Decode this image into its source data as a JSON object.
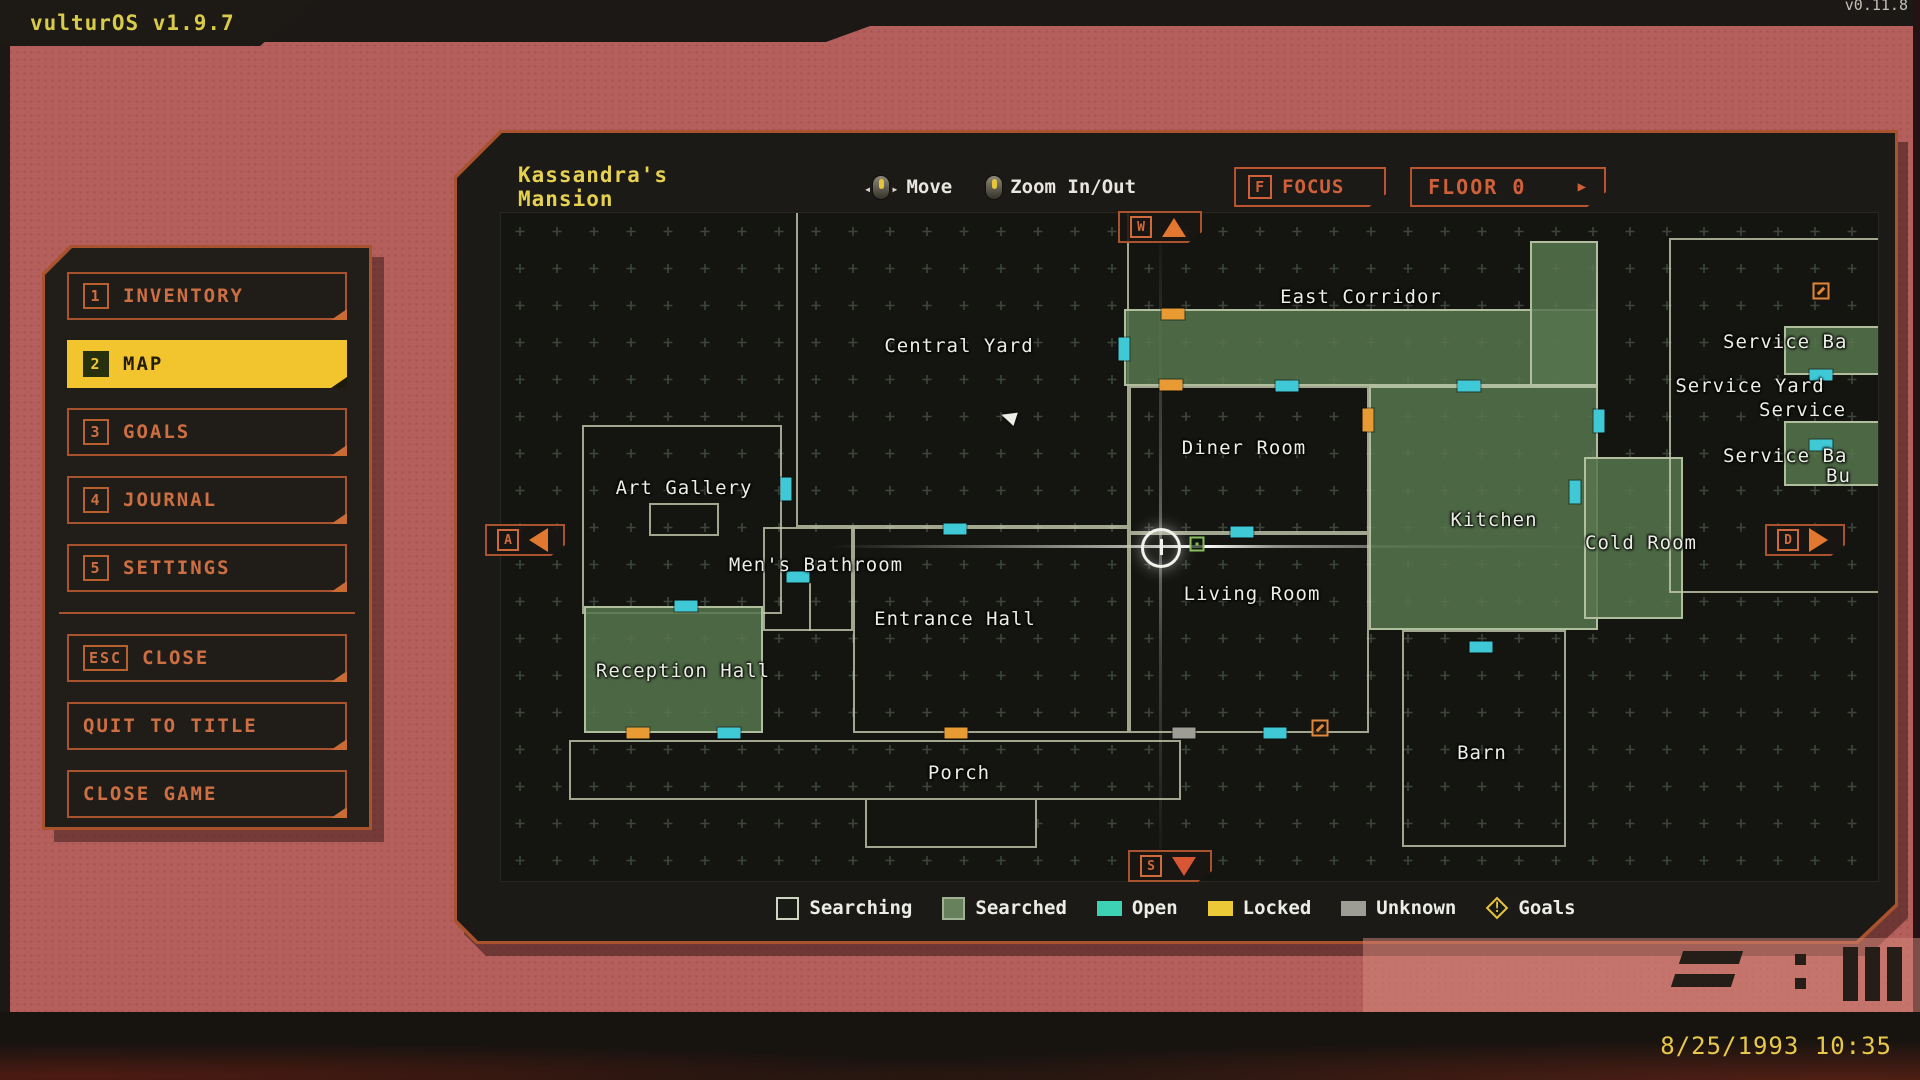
{
  "os": {
    "title": "vulturOS v1.9.7",
    "corner_version": "v0.11.8",
    "datetime": "8/25/1993 10:35"
  },
  "sidebar": {
    "items": [
      {
        "key": "1",
        "label": "INVENTORY"
      },
      {
        "key": "2",
        "label": "MAP"
      },
      {
        "key": "3",
        "label": "GOALS"
      },
      {
        "key": "4",
        "label": "JOURNAL"
      },
      {
        "key": "5",
        "label": "SETTINGS"
      },
      {
        "key": "ESC",
        "label": "CLOSE"
      },
      {
        "key": "",
        "label": "QUIT TO TITLE"
      },
      {
        "key": "",
        "label": "CLOSE GAME"
      }
    ]
  },
  "map": {
    "title": "Kassandra's Mansion",
    "controls": {
      "move_label": "Move",
      "zoom_label": "Zoom In/Out",
      "focus_key": "F",
      "focus_label": "FOCUS",
      "floor_label": "FLOOR 0",
      "floor_arrow": "▶"
    },
    "nav_keys": {
      "up": "W",
      "left": "A",
      "right": "D",
      "down": "S"
    },
    "legend": [
      {
        "label": "Searching"
      },
      {
        "label": "Searched"
      },
      {
        "label": "Open"
      },
      {
        "label": "Locked"
      },
      {
        "label": "Unknown"
      },
      {
        "label": "Goals"
      }
    ],
    "rooms": [
      {
        "id": "central-yard",
        "x": 295,
        "y": -6,
        "w": 333,
        "h": 320,
        "s": "searching"
      },
      {
        "id": "art-gallery",
        "x": 81,
        "y": 212,
        "w": 200,
        "h": 189,
        "s": "searching"
      },
      {
        "id": "gallery-closet",
        "x": 148,
        "y": 290,
        "w": 70,
        "h": 33,
        "s": "searching"
      },
      {
        "id": "mens-bathroom",
        "x": 262,
        "y": 314,
        "w": 90,
        "h": 104,
        "s": "searching"
      },
      {
        "id": "bathroom-divider",
        "x": 308,
        "y": 370,
        "w": 2,
        "h": 48,
        "s": "wall"
      },
      {
        "id": "entrance-hall",
        "x": 352,
        "y": 314,
        "w": 276,
        "h": 206,
        "s": "searching"
      },
      {
        "id": "reception-hall",
        "x": 83,
        "y": 393,
        "w": 179,
        "h": 127,
        "s": "searched"
      },
      {
        "id": "porch",
        "x": 68,
        "y": 527,
        "w": 612,
        "h": 60,
        "s": "searching"
      },
      {
        "id": "porch-steps",
        "x": 364,
        "y": 585,
        "w": 172,
        "h": 50,
        "s": "searching",
        "f": 1
      },
      {
        "id": "diner-room",
        "x": 628,
        "y": 173,
        "w": 240,
        "h": 147,
        "s": "searching"
      },
      {
        "id": "living-room",
        "x": 628,
        "y": 320,
        "w": 240,
        "h": 200,
        "s": "searching"
      },
      {
        "id": "east-corridor",
        "x": 623,
        "y": 96,
        "w": 474,
        "h": 77,
        "s": "searched"
      },
      {
        "id": "east-corridor-upper",
        "x": 1029,
        "y": 28,
        "w": 68,
        "h": 145,
        "s": "searched"
      },
      {
        "id": "kitchen",
        "x": 868,
        "y": 173,
        "w": 229,
        "h": 244,
        "s": "searched"
      },
      {
        "id": "cold-room",
        "x": 1083,
        "y": 244,
        "w": 99,
        "h": 162,
        "s": "searched"
      },
      {
        "id": "barn",
        "x": 901,
        "y": 417,
        "w": 164,
        "h": 217,
        "s": "searching"
      },
      {
        "id": "service-yard",
        "x": 1168,
        "y": 25,
        "w": 215,
        "h": 355,
        "s": "searching"
      },
      {
        "id": "service-room-a",
        "x": 1283,
        "y": 113,
        "w": 100,
        "h": 49,
        "s": "searched"
      },
      {
        "id": "service-room-b",
        "x": 1283,
        "y": 208,
        "w": 100,
        "h": 65,
        "s": "searched"
      }
    ],
    "labels": [
      {
        "t": "Central Yard",
        "x": 458,
        "y": 133
      },
      {
        "t": "East Corridor",
        "x": 860,
        "y": 84
      },
      {
        "t": "Art Gallery",
        "x": 183,
        "y": 275
      },
      {
        "t": "Diner Room",
        "x": 743,
        "y": 235
      },
      {
        "t": "Men's Bathroom",
        "x": 315,
        "y": 352
      },
      {
        "t": "Entrance Hall",
        "x": 454,
        "y": 406
      },
      {
        "t": "Living Room",
        "x": 751,
        "y": 381
      },
      {
        "t": "Reception Hall",
        "x": 182,
        "y": 458
      },
      {
        "t": "Kitchen",
        "x": 993,
        "y": 307
      },
      {
        "t": "Cold Room",
        "x": 1140,
        "y": 330
      },
      {
        "t": "Porch",
        "x": 458,
        "y": 560
      },
      {
        "t": "Barn",
        "x": 981,
        "y": 540
      },
      {
        "t": "Service Yard",
        "x": 1249,
        "y": 173
      },
      {
        "t": "Service Ba",
        "x": 1222,
        "y": 118,
        "a": "l"
      },
      {
        "t": "Service",
        "x": 1258,
        "y": 186,
        "a": "l"
      },
      {
        "t": "Service Ba",
        "x": 1222,
        "y": 232,
        "a": "l"
      },
      {
        "t": "Bu",
        "x": 1325,
        "y": 252,
        "a": "l"
      }
    ],
    "doors": [
      {
        "x": 454,
        "y": 316,
        "o": "h",
        "t": "o"
      },
      {
        "x": 285,
        "y": 276,
        "o": "v",
        "t": "o"
      },
      {
        "x": 297,
        "y": 364,
        "o": "h",
        "t": "o"
      },
      {
        "x": 185,
        "y": 393,
        "o": "h",
        "t": "o"
      },
      {
        "x": 137,
        "y": 520,
        "o": "h",
        "t": "l"
      },
      {
        "x": 228,
        "y": 520,
        "o": "h",
        "t": "o"
      },
      {
        "x": 455,
        "y": 520,
        "o": "h",
        "t": "l"
      },
      {
        "x": 683,
        "y": 520,
        "o": "h",
        "t": "u"
      },
      {
        "x": 774,
        "y": 520,
        "o": "h",
        "t": "o"
      },
      {
        "x": 672,
        "y": 101,
        "o": "h",
        "t": "l"
      },
      {
        "x": 623,
        "y": 136,
        "o": "v",
        "t": "o"
      },
      {
        "x": 670,
        "y": 172,
        "o": "h",
        "t": "l"
      },
      {
        "x": 786,
        "y": 173,
        "o": "h",
        "t": "o"
      },
      {
        "x": 968,
        "y": 173,
        "o": "h",
        "t": "o"
      },
      {
        "x": 867,
        "y": 207,
        "o": "v",
        "t": "l"
      },
      {
        "x": 1098,
        "y": 208,
        "o": "v",
        "t": "o"
      },
      {
        "x": 1074,
        "y": 279,
        "o": "v",
        "t": "o"
      },
      {
        "x": 741,
        "y": 319,
        "o": "h",
        "t": "o"
      },
      {
        "x": 980,
        "y": 434,
        "o": "h",
        "t": "o"
      },
      {
        "x": 1320,
        "y": 162,
        "o": "h",
        "t": "o"
      },
      {
        "x": 1320,
        "y": 232,
        "o": "h",
        "t": "o"
      }
    ],
    "goal_markers": [
      {
        "x": 819,
        "y": 515
      },
      {
        "x": 1320,
        "y": 78
      }
    ],
    "item_markers": [
      {
        "x": 696,
        "y": 331
      }
    ],
    "player": {
      "x": 660,
      "y": 335
    },
    "cursor": {
      "x": 500,
      "y": 197
    }
  },
  "colors": {
    "background": "#b45f5c",
    "panel_border": "#a8522e",
    "active_yellow": "#f2c52f",
    "title_yellow": "#e5d14f",
    "searched_green": "#56764d",
    "open_teal": "#3ed2b5",
    "locked_yellow": "#ecc937",
    "unknown_gray": "#9d9d96",
    "goal_orange": "#e0873a"
  }
}
